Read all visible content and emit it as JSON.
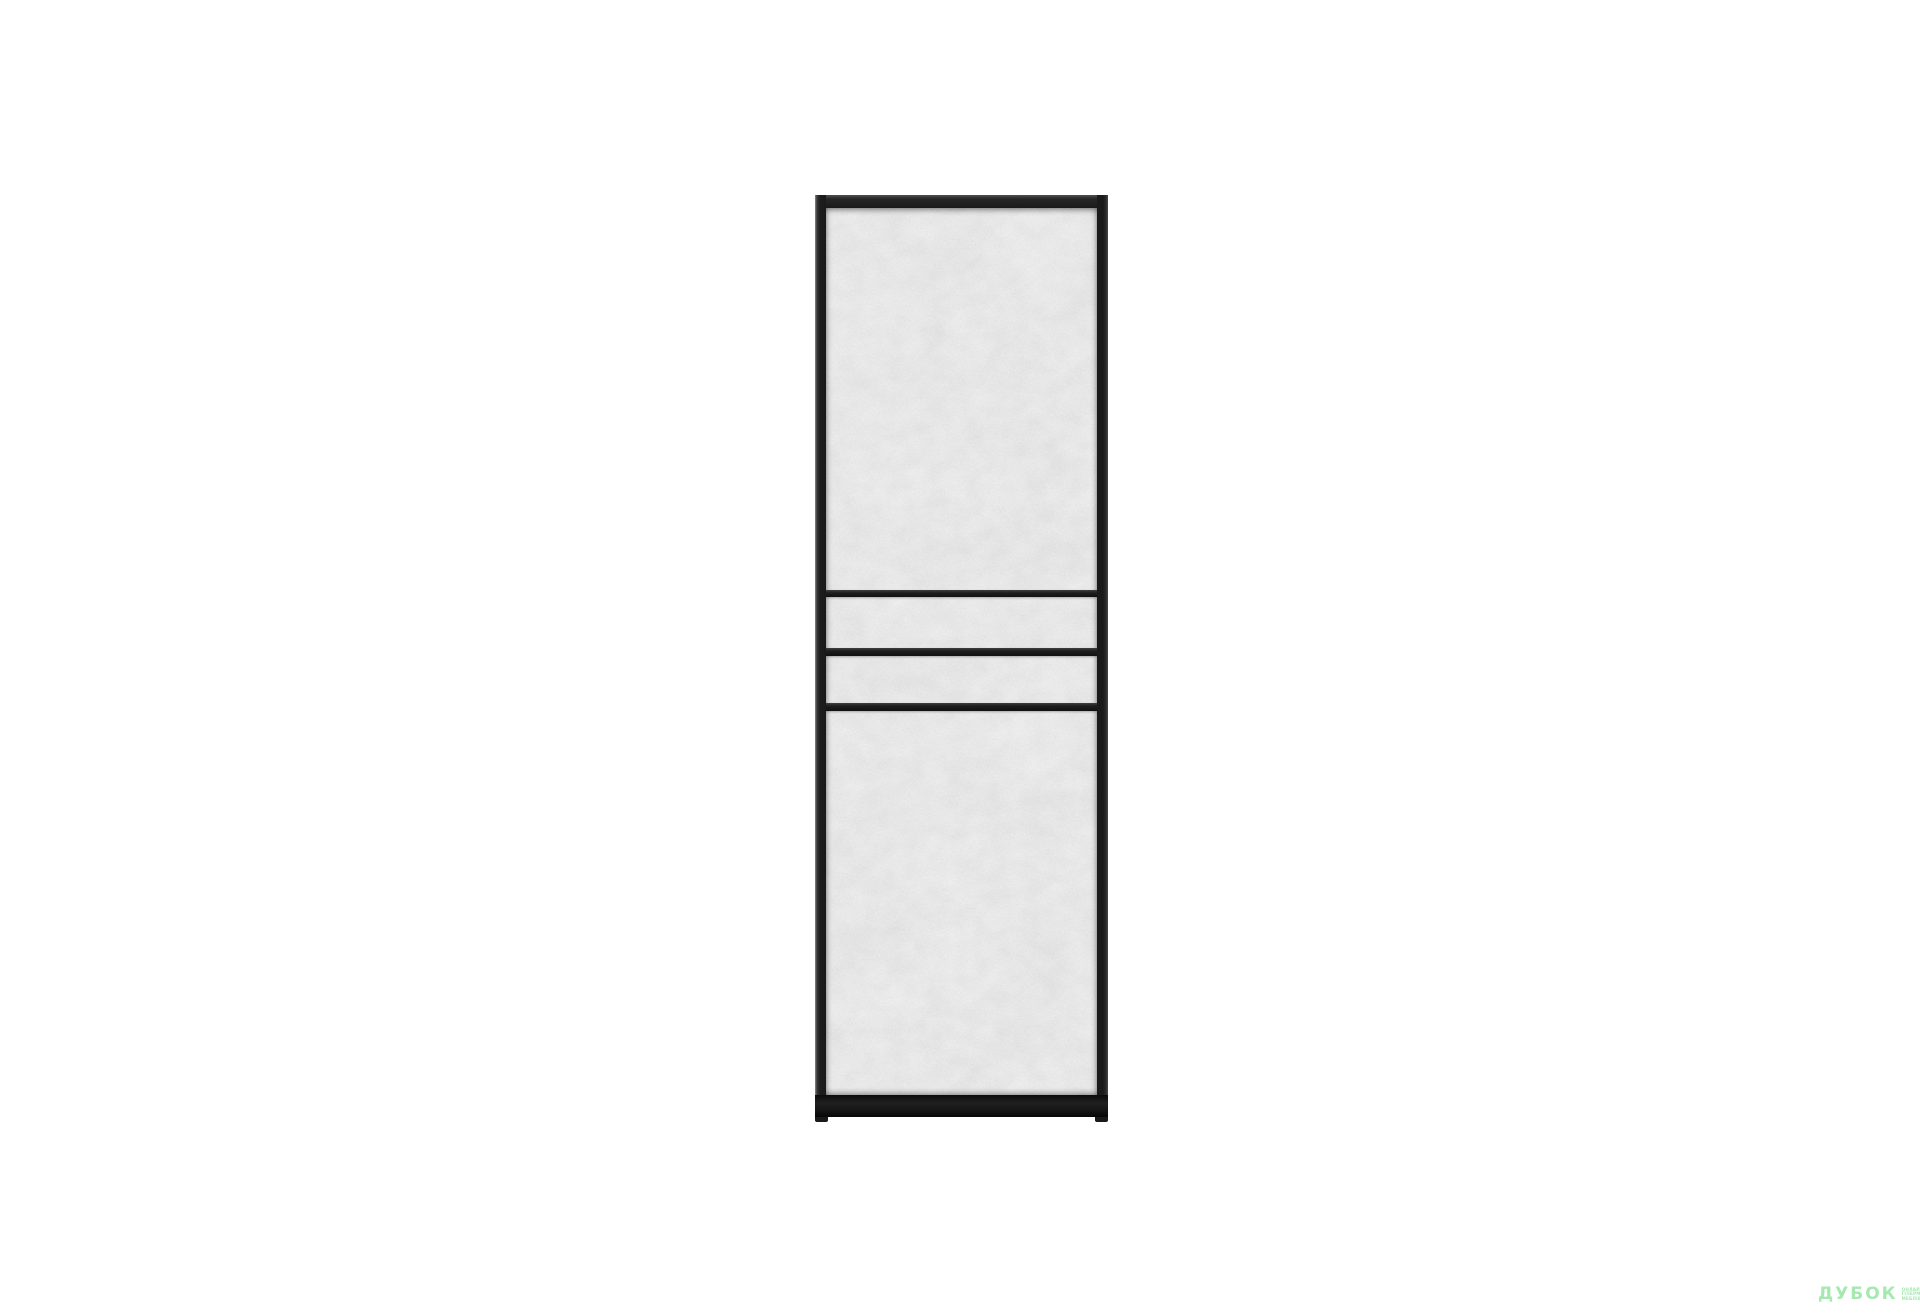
{
  "canvas": {
    "width": 1920,
    "height": 1314,
    "background": "#ffffff"
  },
  "product": {
    "subject": "tall cabinet with black frame and light-gray concrete-texture panels",
    "sections": [
      "upper door",
      "middle band 1",
      "middle band 2",
      "lower door"
    ],
    "divider_stripe_count": 3
  },
  "colors": {
    "background": "#ffffff",
    "frame": "#1a1a1a",
    "panel": "#d0d0d0",
    "watermark": "#a5e9b0"
  },
  "watermark": {
    "logo_text": "ДУБОК",
    "tagline_lines": [
      "ОНЛАЙН",
      "ГІПЕРМАРКЕТ",
      "МЕБЛІВ"
    ]
  }
}
